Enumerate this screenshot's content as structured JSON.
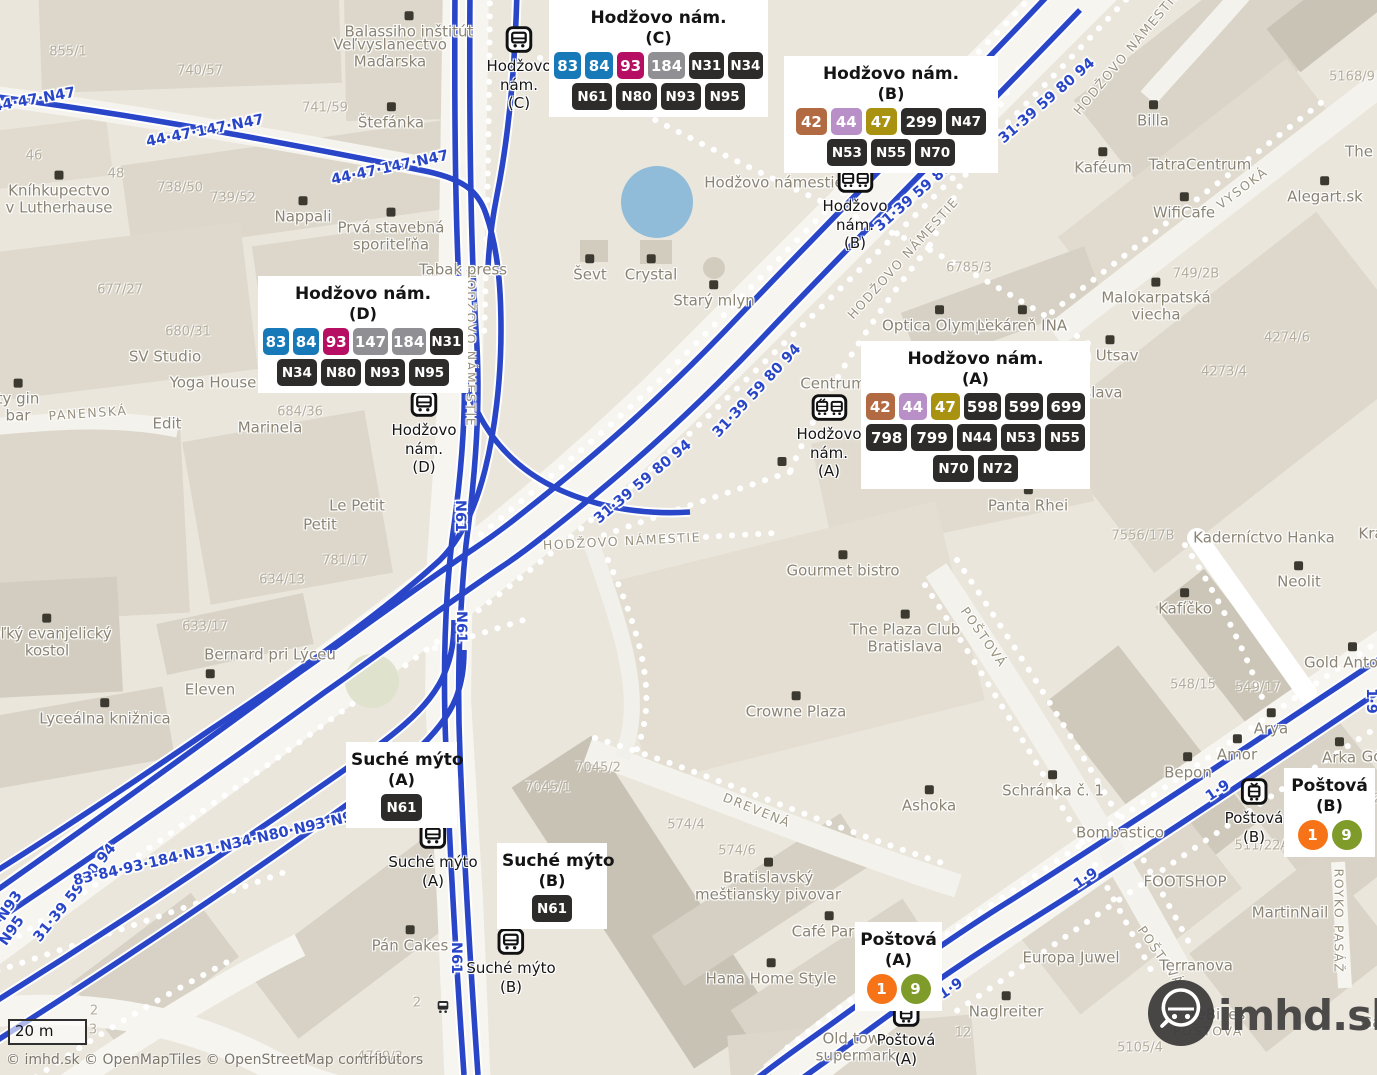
{
  "meta": {
    "attribution": "© imhd.sk © OpenMapTiles © OpenStreetMap contributors",
    "scalebar": {
      "label": "20 m"
    },
    "logo": {
      "text": "imhd.sk"
    }
  },
  "colors": {
    "map_bg": "#eae6dc",
    "route_blue": "#2a46c8",
    "pond_blue": "#90bcd9",
    "badge_blue": "#1879b8",
    "badge_magenta": "#b60e63",
    "badge_gray": "#909094",
    "badge_dark": "#2d2c2b",
    "badge_rust": "#b26a43",
    "badge_lilac": "#b88fc7",
    "badge_olive": "#a99210",
    "badge_orange": "#f67318",
    "badge_green": "#7f9b2a"
  },
  "cards": [
    {
      "id": "hodzovo-nam-c",
      "x": 549,
      "y": 0,
      "w": 209,
      "title": "Hodžovo nám.",
      "platform": "(C)",
      "rows": [
        [
          {
            "label": "83",
            "color": "blue"
          },
          {
            "label": "84",
            "color": "blue"
          },
          {
            "label": "93",
            "color": "magenta"
          },
          {
            "label": "184",
            "color": "gray"
          },
          {
            "label": "N31",
            "color": "dark"
          },
          {
            "label": "N34",
            "color": "dark"
          }
        ],
        [
          {
            "label": "N61",
            "color": "dark"
          },
          {
            "label": "N80",
            "color": "dark"
          },
          {
            "label": "N93",
            "color": "dark"
          },
          {
            "label": "N95",
            "color": "dark"
          }
        ]
      ]
    },
    {
      "id": "hodzovo-nam-b",
      "x": 784,
      "y": 56,
      "w": 204,
      "title": "Hodžovo nám.",
      "platform": "(B)",
      "rows": [
        [
          {
            "label": "42",
            "color": "rust"
          },
          {
            "label": "44",
            "color": "lilac"
          },
          {
            "label": "47",
            "color": "olive"
          },
          {
            "label": "299",
            "color": "dark"
          },
          {
            "label": "N47",
            "color": "dark"
          }
        ],
        [
          {
            "label": "N53",
            "color": "dark"
          },
          {
            "label": "N55",
            "color": "dark"
          },
          {
            "label": "N70",
            "color": "dark"
          }
        ]
      ]
    },
    {
      "id": "hodzovo-nam-d",
      "x": 258,
      "y": 276,
      "w": 200,
      "title": "Hodžovo nám.",
      "platform": "(D)",
      "rows": [
        [
          {
            "label": "83",
            "color": "blue"
          },
          {
            "label": "84",
            "color": "blue"
          },
          {
            "label": "93",
            "color": "magenta"
          },
          {
            "label": "147",
            "color": "gray"
          },
          {
            "label": "184",
            "color": "gray"
          },
          {
            "label": "N31",
            "color": "dark"
          }
        ],
        [
          {
            "label": "N34",
            "color": "dark"
          },
          {
            "label": "N80",
            "color": "dark"
          },
          {
            "label": "N93",
            "color": "dark"
          },
          {
            "label": "N95",
            "color": "dark"
          }
        ]
      ]
    },
    {
      "id": "hodzovo-nam-a",
      "x": 861,
      "y": 341,
      "w": 219,
      "title": "Hodžovo nám.",
      "platform": "(A)",
      "rows": [
        [
          {
            "label": "42",
            "color": "rust"
          },
          {
            "label": "44",
            "color": "lilac"
          },
          {
            "label": "47",
            "color": "olive"
          },
          {
            "label": "598",
            "color": "dark"
          },
          {
            "label": "599",
            "color": "dark"
          },
          {
            "label": "699",
            "color": "dark"
          }
        ],
        [
          {
            "label": "798",
            "color": "dark"
          },
          {
            "label": "799",
            "color": "dark"
          },
          {
            "label": "N44",
            "color": "dark"
          },
          {
            "label": "N53",
            "color": "dark"
          },
          {
            "label": "N55",
            "color": "dark"
          }
        ],
        [
          {
            "label": "N70",
            "color": "dark"
          },
          {
            "label": "N72",
            "color": "dark"
          }
        ]
      ]
    },
    {
      "id": "suche-myto-a",
      "x": 346,
      "y": 742,
      "w": 101,
      "title": "Suché mýto",
      "platform": "(A)",
      "rows": [
        [
          {
            "label": "N61",
            "color": "dark"
          }
        ]
      ]
    },
    {
      "id": "suche-myto-b",
      "x": 497,
      "y": 843,
      "w": 100,
      "title": "Suché mýto",
      "platform": "(B)",
      "rows": [
        [
          {
            "label": "N61",
            "color": "dark"
          }
        ]
      ]
    },
    {
      "id": "postova-a",
      "x": 855,
      "y": 922,
      "w": 77,
      "title": "Poštová",
      "platform": "(A)",
      "rows": [
        [
          {
            "label": "1",
            "color": "orange",
            "shape": "circle"
          },
          {
            "label": "9",
            "color": "green",
            "shape": "circle"
          }
        ]
      ]
    },
    {
      "id": "postova-b",
      "x": 1284,
      "y": 768,
      "w": 81,
      "title": "Poštová",
      "platform": "(B)",
      "rows": [
        [
          {
            "label": "1",
            "color": "orange",
            "shape": "circle"
          },
          {
            "label": "9",
            "color": "green",
            "shape": "circle"
          }
        ]
      ]
    }
  ],
  "markers": [
    {
      "type": "bus",
      "x": 519,
      "y": 26,
      "lines": [
        "Hodžovo",
        "nám.",
        "(C)"
      ]
    },
    {
      "type": "duo",
      "x": 855,
      "y": 166,
      "lines": [
        "Hodžovo",
        "nám.",
        "(B)"
      ]
    },
    {
      "type": "bus",
      "x": 424,
      "y": 390,
      "lines": [
        "Hodžovo",
        "nám.",
        "(D)"
      ]
    },
    {
      "type": "duo",
      "x": 829,
      "y": 394,
      "lines": [
        "Hodžovo",
        "nám.",
        "(A)"
      ]
    },
    {
      "type": "bus",
      "x": 433,
      "y": 822,
      "lines": [
        "Suché mýto",
        "(A)"
      ]
    },
    {
      "type": "bus",
      "x": 511,
      "y": 928,
      "lines": [
        "Suché mýto",
        "(B)"
      ]
    },
    {
      "type": "tram",
      "x": 906,
      "y": 1000,
      "lines": [
        "Poštová",
        "(A)"
      ]
    },
    {
      "type": "tram",
      "x": 1254,
      "y": 778,
      "lines": [
        "Poštová",
        "(B)"
      ]
    },
    {
      "type": "mini",
      "x": 443,
      "y": 999,
      "lines": []
    }
  ],
  "route_labels": [
    {
      "text": "44·47·N47",
      "x": 34,
      "y": 100,
      "rot": -10
    },
    {
      "text": "44·47·147·N47",
      "x": 205,
      "y": 131,
      "rot": -11
    },
    {
      "text": "44·47·147·N47",
      "x": 390,
      "y": 168,
      "rot": -12
    },
    {
      "text": "31·39 59 80 94",
      "x": 1047,
      "y": 101,
      "rot": -41
    },
    {
      "text": "31·39 59 80 94",
      "x": 923,
      "y": 189,
      "rot": -41
    },
    {
      "text": "31·39 59 80 94",
      "x": 757,
      "y": 391,
      "rot": -47
    },
    {
      "text": "31·39 59 80 94",
      "x": 643,
      "y": 482,
      "rot": -40
    },
    {
      "text": "31·39 59 80 94",
      "x": 75,
      "y": 893,
      "rot": -51
    },
    {
      "text": "83·84·93·184·N31·N34·N80·N93·N95",
      "x": 218,
      "y": 848,
      "rot": -13
    },
    {
      "text": "N93",
      "x": 10,
      "y": 906,
      "rot": -55
    },
    {
      "text": "N95",
      "x": 12,
      "y": 931,
      "rot": -55
    },
    {
      "text": "N61",
      "x": 460,
      "y": 516,
      "rot": 90
    },
    {
      "text": "N61",
      "x": 461,
      "y": 627,
      "rot": 90
    },
    {
      "text": "N61",
      "x": 452,
      "y": 792,
      "rot": -90
    },
    {
      "text": "N61",
      "x": 456,
      "y": 958,
      "rot": 90
    },
    {
      "text": "1·9",
      "x": 1218,
      "y": 791,
      "rot": -34
    },
    {
      "text": "1·9",
      "x": 1086,
      "y": 879,
      "rot": -34
    },
    {
      "text": "1·9",
      "x": 951,
      "y": 989,
      "rot": -34
    },
    {
      "text": "1·9",
      "x": 1371,
      "y": 701,
      "rot": 90
    }
  ],
  "street_labels": [
    {
      "text": "HODŽOVO NÁMESTIE",
      "x": 1127,
      "y": 52,
      "rot": -50
    },
    {
      "text": "HODŽOVO NÁMESTIE",
      "x": 903,
      "y": 258,
      "rot": -48
    },
    {
      "text": "HODŽOVO NÁMESTIE",
      "x": 622,
      "y": 541,
      "rot": -3
    },
    {
      "text": "HODŽOVO NÁMESTIE",
      "x": 471,
      "y": 348,
      "rot": 90
    },
    {
      "text": "VYSOKÁ",
      "x": 1242,
      "y": 188,
      "rot": -37
    },
    {
      "text": "POŠTOVÁ",
      "x": 984,
      "y": 637,
      "rot": 55
    },
    {
      "text": "POŠTOVÁ",
      "x": 1161,
      "y": 956,
      "rot": 55
    },
    {
      "text": "DREVENÁ",
      "x": 757,
      "y": 810,
      "rot": 22
    },
    {
      "text": "ROYKO PASÁŽ",
      "x": 1339,
      "y": 921,
      "rot": 90
    },
    {
      "text": "PANENSKÁ",
      "x": 88,
      "y": 413,
      "rot": -4
    },
    {
      "text": "POŠTOVÁ",
      "x": 1208,
      "y": 1031,
      "rot": 0
    }
  ],
  "pois": [
    {
      "icon": "museum-icon",
      "lines": [
        "Balassiho inštitút"
      ],
      "x": 409,
      "y": 26
    },
    {
      "lines": [
        "Veľvyslanectvo",
        "Maďarska"
      ],
      "x": 390,
      "y": 54
    },
    {
      "icon": "restaurant-icon",
      "lines": [
        "Štefánka"
      ],
      "x": 391,
      "y": 117
    },
    {
      "icon": "book-icon",
      "lines": [
        "Kníhkupectvo",
        "v Lutherhause"
      ],
      "x": 59,
      "y": 194
    },
    {
      "icon": "cafe-icon",
      "lines": [
        "Nappali"
      ],
      "x": 303,
      "y": 211
    },
    {
      "icon": "bank-icon",
      "lines": [
        "Prvá stavebná",
        "sporiteľňa"
      ],
      "x": 391,
      "y": 231
    },
    {
      "lines": [
        "Tabak press"
      ],
      "x": 463,
      "y": 270
    },
    {
      "icon": "bag-icon",
      "lines": [
        "Ševt"
      ],
      "x": 590,
      "y": 269
    },
    {
      "icon": "bag-icon",
      "lines": [
        "Crystal"
      ],
      "x": 651,
      "y": 269
    },
    {
      "lines": [
        "Hodžovo námestie"
      ],
      "x": 774,
      "y": 183
    },
    {
      "icon": "fountain-icon",
      "lines": [
        "Starý mlyn"
      ],
      "x": 714,
      "y": 295
    },
    {
      "icon": "cart-icon",
      "lines": [
        "Billa"
      ],
      "x": 1153,
      "y": 115
    },
    {
      "icon": "cafe-icon",
      "lines": [
        "Kaféum"
      ],
      "x": 1103,
      "y": 162
    },
    {
      "lines": [
        "TatraCentrum"
      ],
      "x": 1200,
      "y": 165
    },
    {
      "icon": "cafe-icon",
      "lines": [
        "WifiCafe"
      ],
      "x": 1184,
      "y": 207
    },
    {
      "icon": "art-icon",
      "lines": [
        "Alegart.sk"
      ],
      "x": 1325,
      "y": 191
    },
    {
      "lines": [
        "The"
      ],
      "x": 1359,
      "y": 152
    },
    {
      "icon": "bag-icon",
      "lines": [
        "Optica Olympia"
      ],
      "x": 940,
      "y": 320
    },
    {
      "icon": "pharmacy-icon",
      "lines": [
        "Lekáreň INA"
      ],
      "x": 1022,
      "y": 320
    },
    {
      "icon": "drink-icon",
      "lines": [
        "Malokarpatská",
        "viecha"
      ],
      "x": 1156,
      "y": 301
    },
    {
      "icon": "restaurant-icon",
      "lines": [
        "h Utsav"
      ],
      "x": 1110,
      "y": 350
    },
    {
      "lines": [
        "slava"
      ],
      "x": 1103,
      "y": 393
    },
    {
      "lines": [
        "Centrum"
      ],
      "x": 833,
      "y": 384
    },
    {
      "icon": "book-icon",
      "lines": [
        "Panta Rhei"
      ],
      "x": 1028,
      "y": 500
    },
    {
      "lines": [
        "Kaderníctvo Hanka"
      ],
      "x": 1264,
      "y": 538
    },
    {
      "lines": [
        "Krá"
      ],
      "x": 1371,
      "y": 534
    },
    {
      "icon": "restaurant-icon",
      "lines": [
        "Neolit"
      ],
      "x": 1299,
      "y": 576
    },
    {
      "icon": "cafe-icon",
      "lines": [
        "Kafíčko"
      ],
      "x": 1185,
      "y": 603
    },
    {
      "icon": "bag-icon",
      "lines": [
        "Gold Antonic"
      ],
      "x": 1352,
      "y": 657
    },
    {
      "icon": "burger-icon",
      "lines": [
        "Arya"
      ],
      "x": 1271,
      "y": 723
    },
    {
      "icon": "bag-icon",
      "lines": [
        "Amor"
      ],
      "x": 1237,
      "y": 749
    },
    {
      "icon": "clothes-icon",
      "lines": [
        "Bepon"
      ],
      "x": 1188,
      "y": 767
    },
    {
      "icon": "bag-icon",
      "lines": [
        "Arka"
      ],
      "x": 1339,
      "y": 752
    },
    {
      "lines": [
        "Gó"
      ],
      "x": 1372,
      "y": 757
    },
    {
      "icon": "restaurant-icon",
      "lines": [
        "Gourmet bistro"
      ],
      "x": 843,
      "y": 565
    },
    {
      "icon": "cocktail-icon",
      "lines": [
        "The Plaza Club",
        "Bratislava"
      ],
      "x": 905,
      "y": 633
    },
    {
      "icon": "hotel-icon",
      "lines": [
        "Crowne Plaza"
      ],
      "x": 796,
      "y": 706
    },
    {
      "icon": "restaurant-icon",
      "lines": [
        "Ashoka"
      ],
      "x": 929,
      "y": 800
    },
    {
      "icon": "mail-icon",
      "lines": [
        "Schránka č. 1"
      ],
      "x": 1053,
      "y": 785
    },
    {
      "lines": [
        "Bombastico"
      ],
      "x": 1120,
      "y": 833
    },
    {
      "icon": "restaurant-icon",
      "lines": [
        "Bratislavský",
        "meštiansky pivovar"
      ],
      "x": 768,
      "y": 881
    },
    {
      "icon": "cafe-icon",
      "lines": [
        "Café Paris"
      ],
      "x": 829,
      "y": 926
    },
    {
      "icon": "bag-icon",
      "lines": [
        "Hana Home Style"
      ],
      "x": 771,
      "y": 973
    },
    {
      "lines": [
        "Old town",
        "supermark"
      ],
      "x": 856,
      "y": 1048
    },
    {
      "lines": [
        "MartinNail"
      ],
      "x": 1290,
      "y": 913
    },
    {
      "lines": [
        "Europa Juwel"
      ],
      "x": 1071,
      "y": 958
    },
    {
      "icon": "dot-icon",
      "lines": [
        "Naglreiter"
      ],
      "x": 1006,
      "y": 1006
    },
    {
      "lines": [
        "FOOTSHOP"
      ],
      "x": 1185,
      "y": 882
    },
    {
      "lines": [
        "Terranova"
      ],
      "x": 1196,
      "y": 966
    },
    {
      "icon": "church-icon",
      "lines": [
        "Veľký evanjelický",
        "kostol"
      ],
      "x": 47,
      "y": 637
    },
    {
      "icon": "book-icon",
      "lines": [
        "Lyceálna knižnica"
      ],
      "x": 105,
      "y": 713
    },
    {
      "icon": "cafe-icon",
      "lines": [
        "Eleven"
      ],
      "x": 210,
      "y": 684
    },
    {
      "lines": [
        "SV Studio"
      ],
      "x": 165,
      "y": 357
    },
    {
      "lines": [
        "Yoga House"
      ],
      "x": 213,
      "y": 383
    },
    {
      "lines": [
        "Edit"
      ],
      "x": 167,
      "y": 424
    },
    {
      "lines": [
        "Marinela"
      ],
      "x": 270,
      "y": 428
    },
    {
      "lines": [
        "Le Petit"
      ],
      "x": 357,
      "y": 506
    },
    {
      "lines": [
        "Petit"
      ],
      "x": 320,
      "y": 525
    },
    {
      "icon": "drink-icon",
      "lines": [
        "ty gin",
        "bar"
      ],
      "x": 18,
      "y": 402
    },
    {
      "icon": "cake-icon",
      "lines": [
        "Pán Cakes"
      ],
      "x": 410,
      "y": 940
    },
    {
      "lines": [
        "Bernard pri Lýceu"
      ],
      "x": 270,
      "y": 655
    },
    {
      "icon": "mail-icon",
      "lines": [],
      "x": 782,
      "y": 463
    },
    {
      "lines": [
        "reBikes"
      ],
      "x": 1218,
      "y": 1015
    },
    {
      "lines": [
        "Ga"
      ],
      "x": 1371,
      "y": 1023
    }
  ],
  "parcels": [
    {
      "text": "855/1",
      "x": 68,
      "y": 52
    },
    {
      "text": "740/57",
      "x": 200,
      "y": 71
    },
    {
      "text": "741/59",
      "x": 325,
      "y": 108
    },
    {
      "text": "46",
      "x": 34,
      "y": 156
    },
    {
      "text": "48",
      "x": 116,
      "y": 174
    },
    {
      "text": "738/50",
      "x": 180,
      "y": 188
    },
    {
      "text": "739/52",
      "x": 233,
      "y": 198
    },
    {
      "text": "677/27",
      "x": 120,
      "y": 290
    },
    {
      "text": "680/31",
      "x": 188,
      "y": 332
    },
    {
      "text": "684/36",
      "x": 300,
      "y": 412
    },
    {
      "text": "781/17",
      "x": 345,
      "y": 561
    },
    {
      "text": "634/13",
      "x": 282,
      "y": 580
    },
    {
      "text": "633/17",
      "x": 205,
      "y": 627
    },
    {
      "text": "5168/9",
      "x": 1352,
      "y": 77
    },
    {
      "text": "6785/3",
      "x": 969,
      "y": 268
    },
    {
      "text": "749/2B",
      "x": 1196,
      "y": 274
    },
    {
      "text": "4274/6",
      "x": 1287,
      "y": 338
    },
    {
      "text": "4273/4",
      "x": 1224,
      "y": 372
    },
    {
      "text": "7556/17B",
      "x": 1143,
      "y": 536
    },
    {
      "text": "548/15",
      "x": 1193,
      "y": 685
    },
    {
      "text": "549/17",
      "x": 1258,
      "y": 688
    },
    {
      "text": "7045/2",
      "x": 598,
      "y": 768
    },
    {
      "text": "7045/1",
      "x": 548,
      "y": 788
    },
    {
      "text": "574/4",
      "x": 686,
      "y": 825
    },
    {
      "text": "574/6",
      "x": 737,
      "y": 851
    },
    {
      "text": "511/22A",
      "x": 1262,
      "y": 846
    },
    {
      "text": "24",
      "x": 1302,
      "y": 848
    },
    {
      "text": "26",
      "x": 1360,
      "y": 852
    },
    {
      "text": "7/2",
      "x": 1371,
      "y": 799
    },
    {
      "text": "12",
      "x": 963,
      "y": 1033
    },
    {
      "text": "5105/4",
      "x": 1140,
      "y": 1048
    },
    {
      "text": "4769/2",
      "x": 380,
      "y": 1057
    },
    {
      "text": "2",
      "x": 417,
      "y": 1003
    },
    {
      "text": "2",
      "x": 94,
      "y": 1011
    },
    {
      "text": "3",
      "x": 93,
      "y": 1030
    }
  ]
}
